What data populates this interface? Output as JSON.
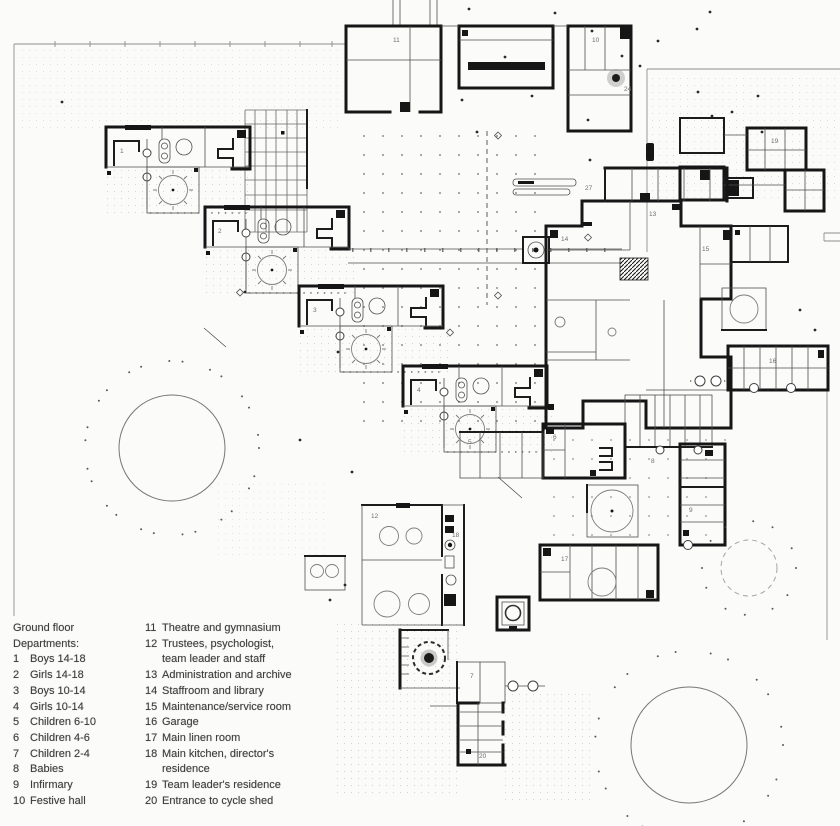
{
  "legend": {
    "title": "Ground floor\nDepartments:",
    "col1": [
      {
        "num": "1",
        "lines": [
          "Boys 14-18"
        ]
      },
      {
        "num": "2",
        "lines": [
          "Girls 14-18"
        ]
      },
      {
        "num": "3",
        "lines": [
          "Boys 10-14"
        ]
      },
      {
        "num": "4",
        "lines": [
          "Girls 10-14"
        ]
      },
      {
        "num": "5",
        "lines": [
          "Children 6-10"
        ]
      },
      {
        "num": "6",
        "lines": [
          "Children 4-6"
        ]
      },
      {
        "num": "7",
        "lines": [
          "Children 2-4"
        ]
      },
      {
        "num": "8",
        "lines": [
          "Babies"
        ]
      },
      {
        "num": "9",
        "lines": [
          "Infirmary"
        ]
      },
      {
        "num": "10",
        "lines": [
          "Festive hall"
        ]
      }
    ],
    "col2": [
      {
        "num": "11",
        "lines": [
          "Theatre and gymnasium"
        ]
      },
      {
        "num": "12",
        "lines": [
          "Trustees, psychologist,",
          "team leader and staff"
        ]
      },
      {
        "num": "13",
        "lines": [
          "Administration and archive"
        ]
      },
      {
        "num": "14",
        "lines": [
          "Staffroom and library"
        ]
      },
      {
        "num": "15",
        "lines": [
          "Maintenance/service room"
        ]
      },
      {
        "num": "16",
        "lines": [
          "Garage"
        ]
      },
      {
        "num": "17",
        "lines": [
          "Main linen room"
        ]
      },
      {
        "num": "18",
        "lines": [
          "Main kitchen, director's",
          "residence"
        ]
      },
      {
        "num": "19",
        "lines": [
          "Team leader's residence"
        ]
      },
      {
        "num": "20",
        "lines": [
          "Entrance to cycle shed"
        ]
      }
    ]
  },
  "plan": {
    "colors": {
      "wall": "#161616",
      "thin": "#4f4f4f",
      "paper": "#fbfbf9",
      "faint": "#8d8d8d"
    },
    "labels": [
      {
        "x": 120,
        "y": 153,
        "t": "1"
      },
      {
        "x": 218,
        "y": 233,
        "t": "2"
      },
      {
        "x": 313,
        "y": 312,
        "t": "3"
      },
      {
        "x": 417,
        "y": 392,
        "t": "4"
      },
      {
        "x": 468,
        "y": 444,
        "t": "5"
      },
      {
        "x": 553,
        "y": 439,
        "t": "6"
      },
      {
        "x": 470,
        "y": 678,
        "t": "7"
      },
      {
        "x": 651,
        "y": 463,
        "t": "8"
      },
      {
        "x": 689,
        "y": 512,
        "t": "9"
      },
      {
        "x": 592,
        "y": 42,
        "t": "10"
      },
      {
        "x": 393,
        "y": 42,
        "t": "11"
      },
      {
        "x": 371,
        "y": 518,
        "t": "12"
      },
      {
        "x": 649,
        "y": 216,
        "t": "13"
      },
      {
        "x": 561,
        "y": 241,
        "t": "14"
      },
      {
        "x": 702,
        "y": 251,
        "t": "15"
      },
      {
        "x": 769,
        "y": 363,
        "t": "16"
      },
      {
        "x": 561,
        "y": 561,
        "t": "17"
      },
      {
        "x": 452,
        "y": 537,
        "t": "18"
      },
      {
        "x": 771,
        "y": 143,
        "t": "19"
      },
      {
        "x": 479,
        "y": 758,
        "t": "20"
      },
      {
        "x": 585,
        "y": 190,
        "t": "27"
      },
      {
        "x": 624,
        "y": 91,
        "t": "24"
      }
    ],
    "trees": [
      {
        "cx": 172,
        "cy": 448,
        "r": 53,
        "ring": 90,
        "n": 26
      },
      {
        "cx": 689,
        "cy": 745,
        "r": 58,
        "ring": 97,
        "n": 22
      },
      {
        "cx": 749,
        "cy": 568,
        "r": 28,
        "ring": 50,
        "n": 12,
        "dashed": true,
        "gray": true
      },
      {
        "cx": 616,
        "cy": 78,
        "r": 4,
        "halo": 9
      }
    ],
    "scatter": [
      [
        469,
        9
      ],
      [
        555,
        13
      ],
      [
        592,
        31
      ],
      [
        622,
        56
      ],
      [
        658,
        41
      ],
      [
        697,
        29
      ],
      [
        712,
        116
      ],
      [
        758,
        96
      ],
      [
        640,
        66
      ],
      [
        588,
        120
      ],
      [
        505,
        57
      ],
      [
        532,
        96
      ],
      [
        477,
        132
      ],
      [
        710,
        12
      ],
      [
        462,
        100
      ],
      [
        800,
        310
      ],
      [
        815,
        330
      ],
      [
        352,
        472
      ],
      [
        300,
        440
      ],
      [
        338,
        352
      ],
      [
        245,
        292
      ],
      [
        62,
        102
      ],
      [
        698,
        92
      ],
      [
        732,
        112
      ],
      [
        762,
        132
      ],
      [
        590,
        160
      ],
      [
        345,
        585
      ],
      [
        330,
        600
      ]
    ]
  }
}
